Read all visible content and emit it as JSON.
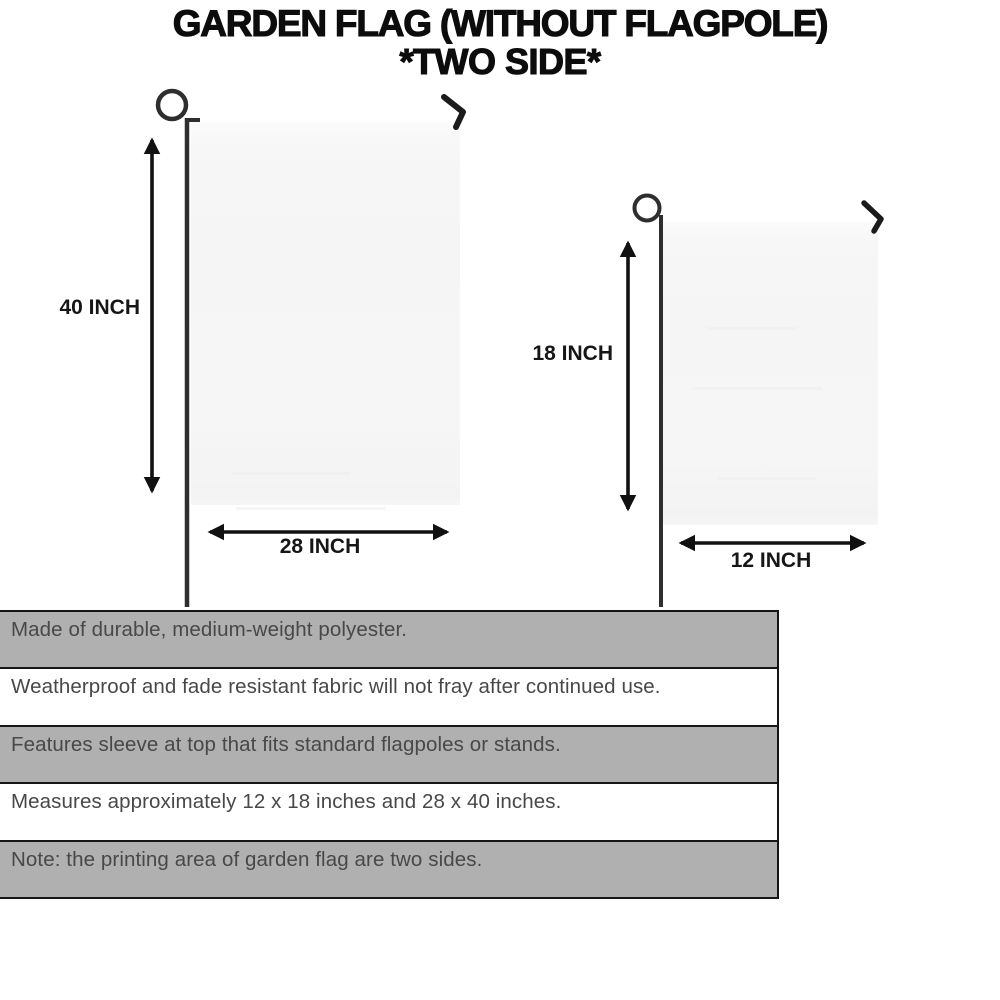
{
  "title": {
    "line1": "GARDEN FLAG (WITHOUT FLAGPOLE)",
    "line2": "*TWO SIDE*"
  },
  "diagram": {
    "large_flag": {
      "height_label": "40 INCH",
      "width_label": "28 INCH"
    },
    "small_flag": {
      "height_label": "18 INCH",
      "width_label": "12 INCH"
    }
  },
  "features": [
    "Made of durable, medium-weight polyester.",
    "Weatherproof and fade resistant fabric will not fray after continued use.",
    "Features sleeve at top that fits standard flagpoles or stands.",
    "Measures approximately 12 x 18 inches and 28 x 40 inches.",
    "Note: the printing area of garden flag are two sides."
  ],
  "colors": {
    "row_gray": "#b0b0b0",
    "row_white": "#ffffff",
    "table_border": "#161616",
    "feature_text": "#484848",
    "title_text": "#0c0c0c",
    "metal_pole": "#2e2e2e",
    "arrow": "#111111",
    "flag_fill": "#f5f5f5"
  }
}
